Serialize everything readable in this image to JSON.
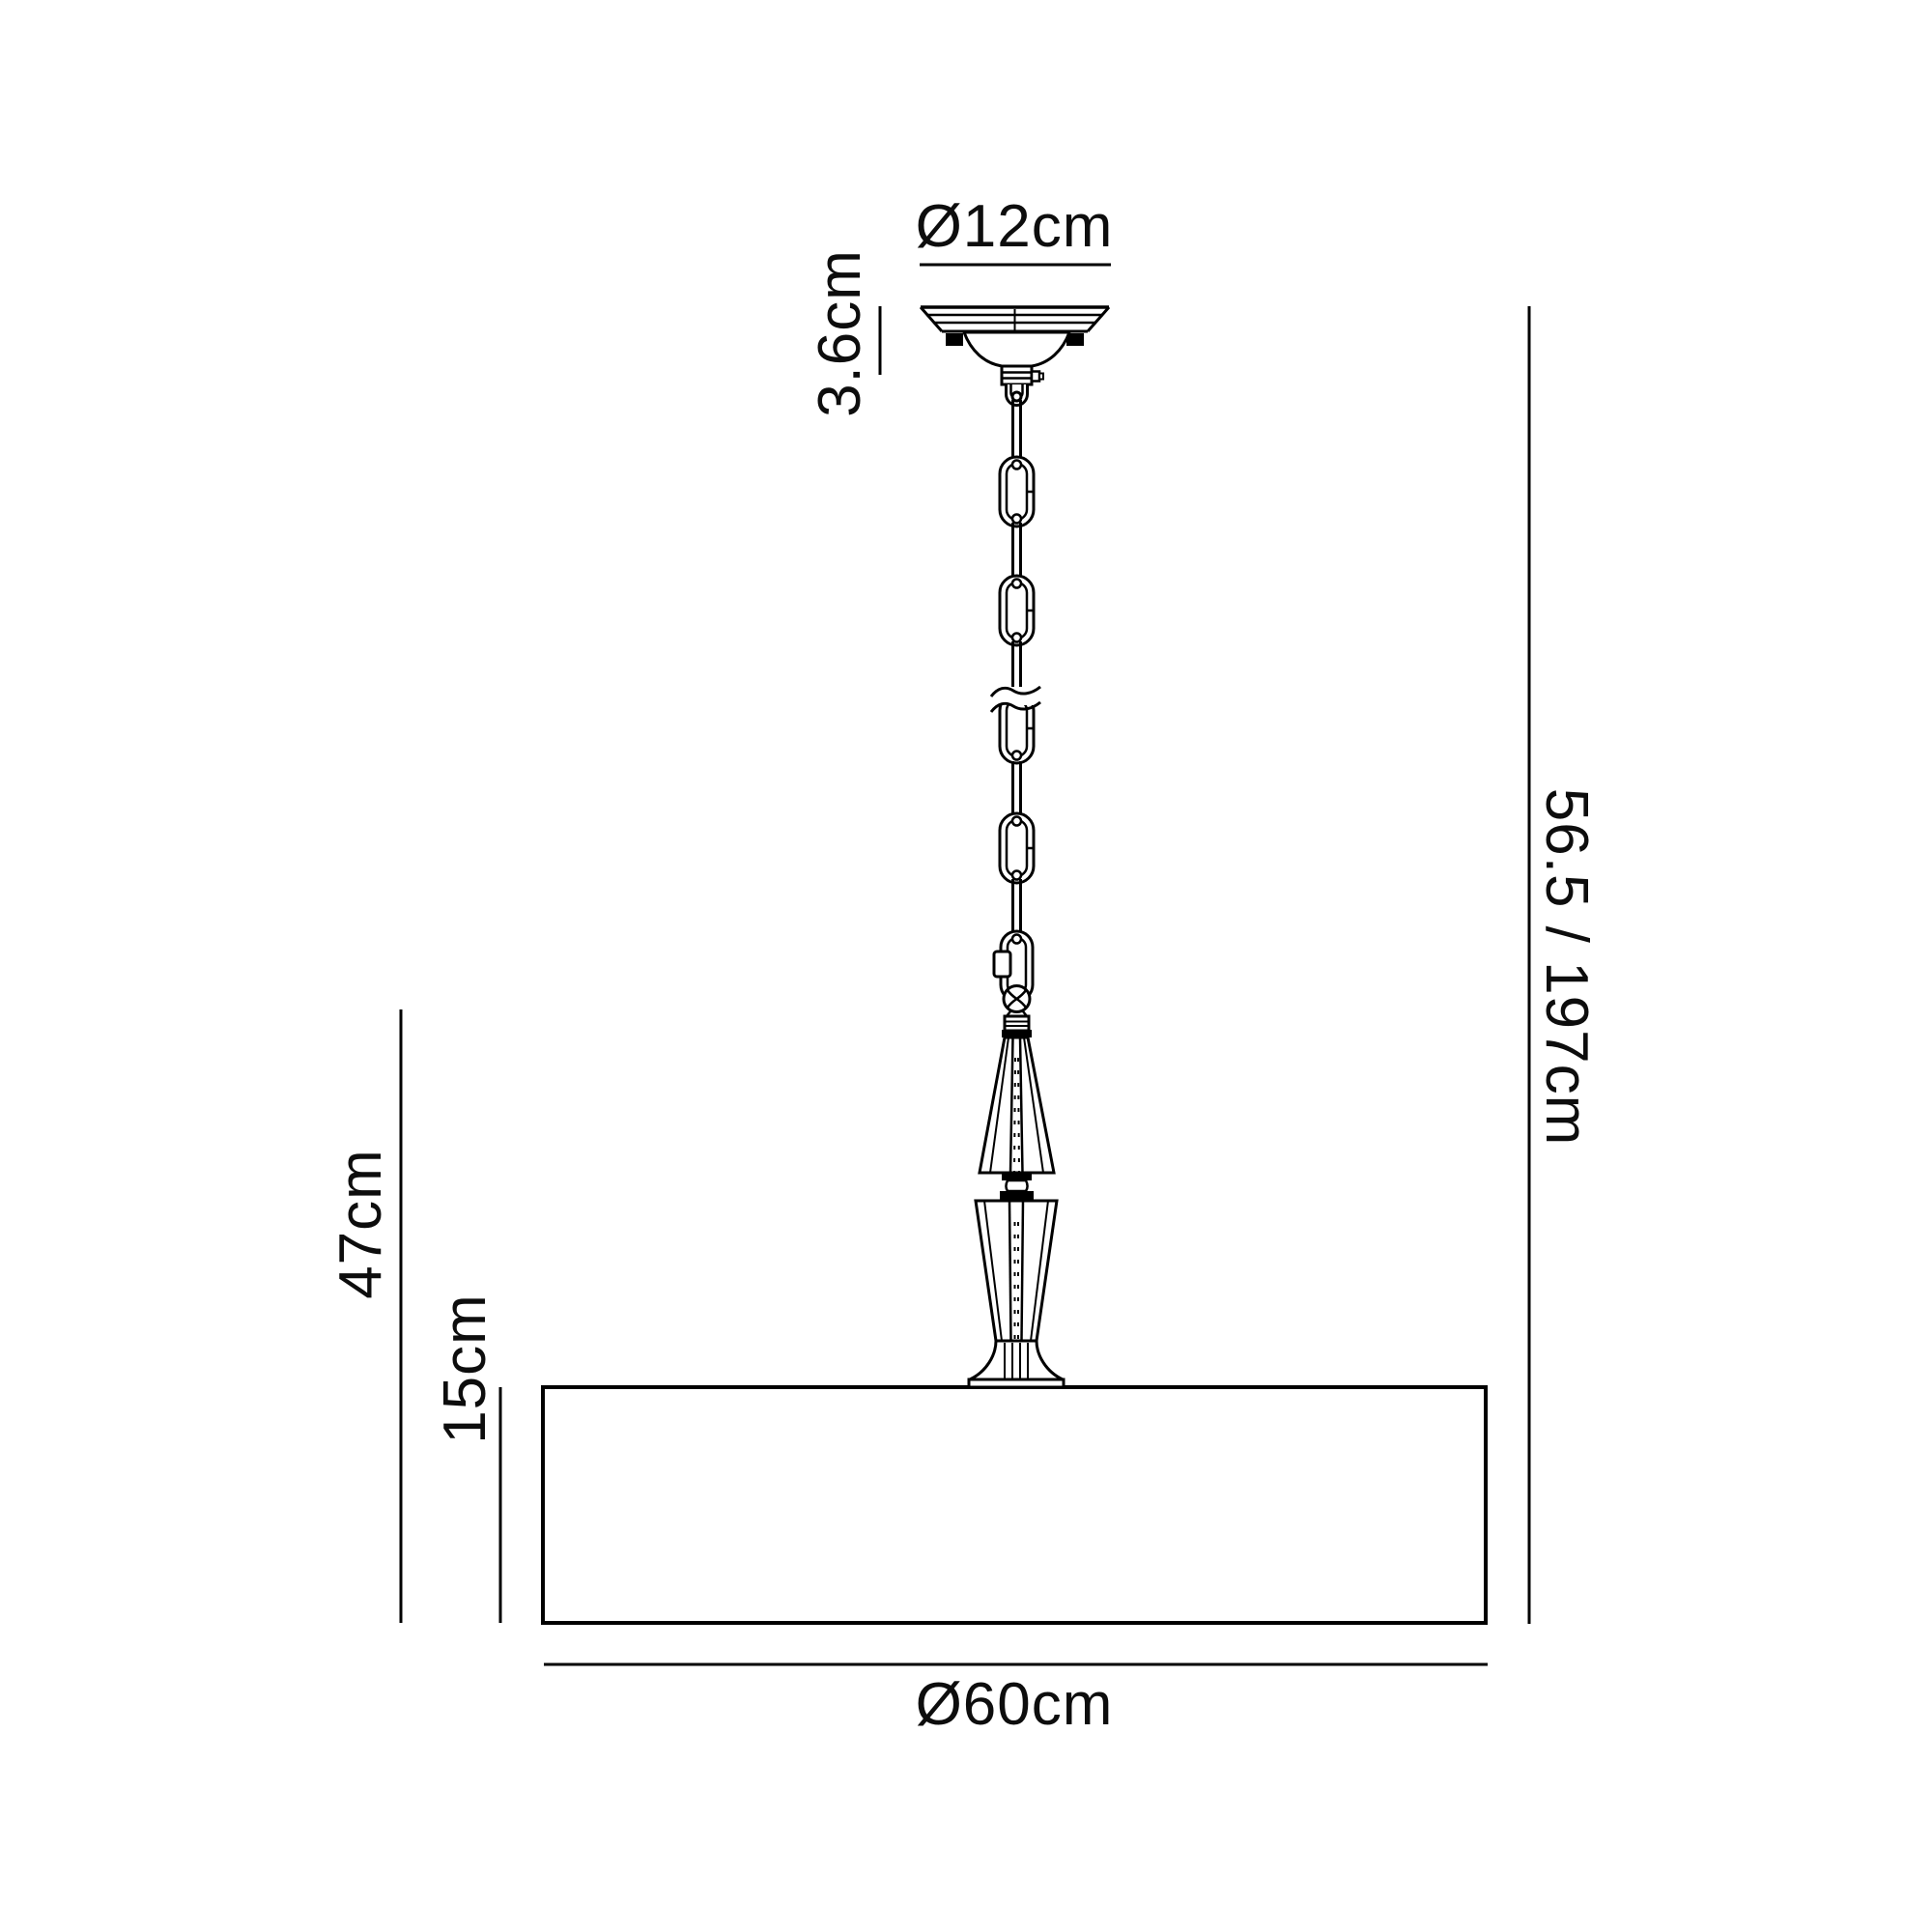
{
  "canvas": {
    "background": "#ffffff",
    "line_color": "#000000"
  },
  "diagram": {
    "type": "pendant-light-dimension-drawing",
    "components": [
      "ceiling-canopy",
      "suspension-chain",
      "chain-break-symbol",
      "quick-link-connector",
      "faceted-ball",
      "upper-crystal-element",
      "spool-connector",
      "lower-crystal-element",
      "trumpet-base",
      "drum-shade"
    ],
    "dimensions": {
      "canopy_diameter": {
        "label": "Ø12cm"
      },
      "canopy_height": {
        "label": "3.6cm"
      },
      "drop_height": {
        "label": "56.5 / 197cm"
      },
      "fixture_height": {
        "label": "47cm"
      },
      "shade_height": {
        "label": "15cm"
      },
      "shade_diameter": {
        "label": "Ø60cm"
      }
    }
  }
}
